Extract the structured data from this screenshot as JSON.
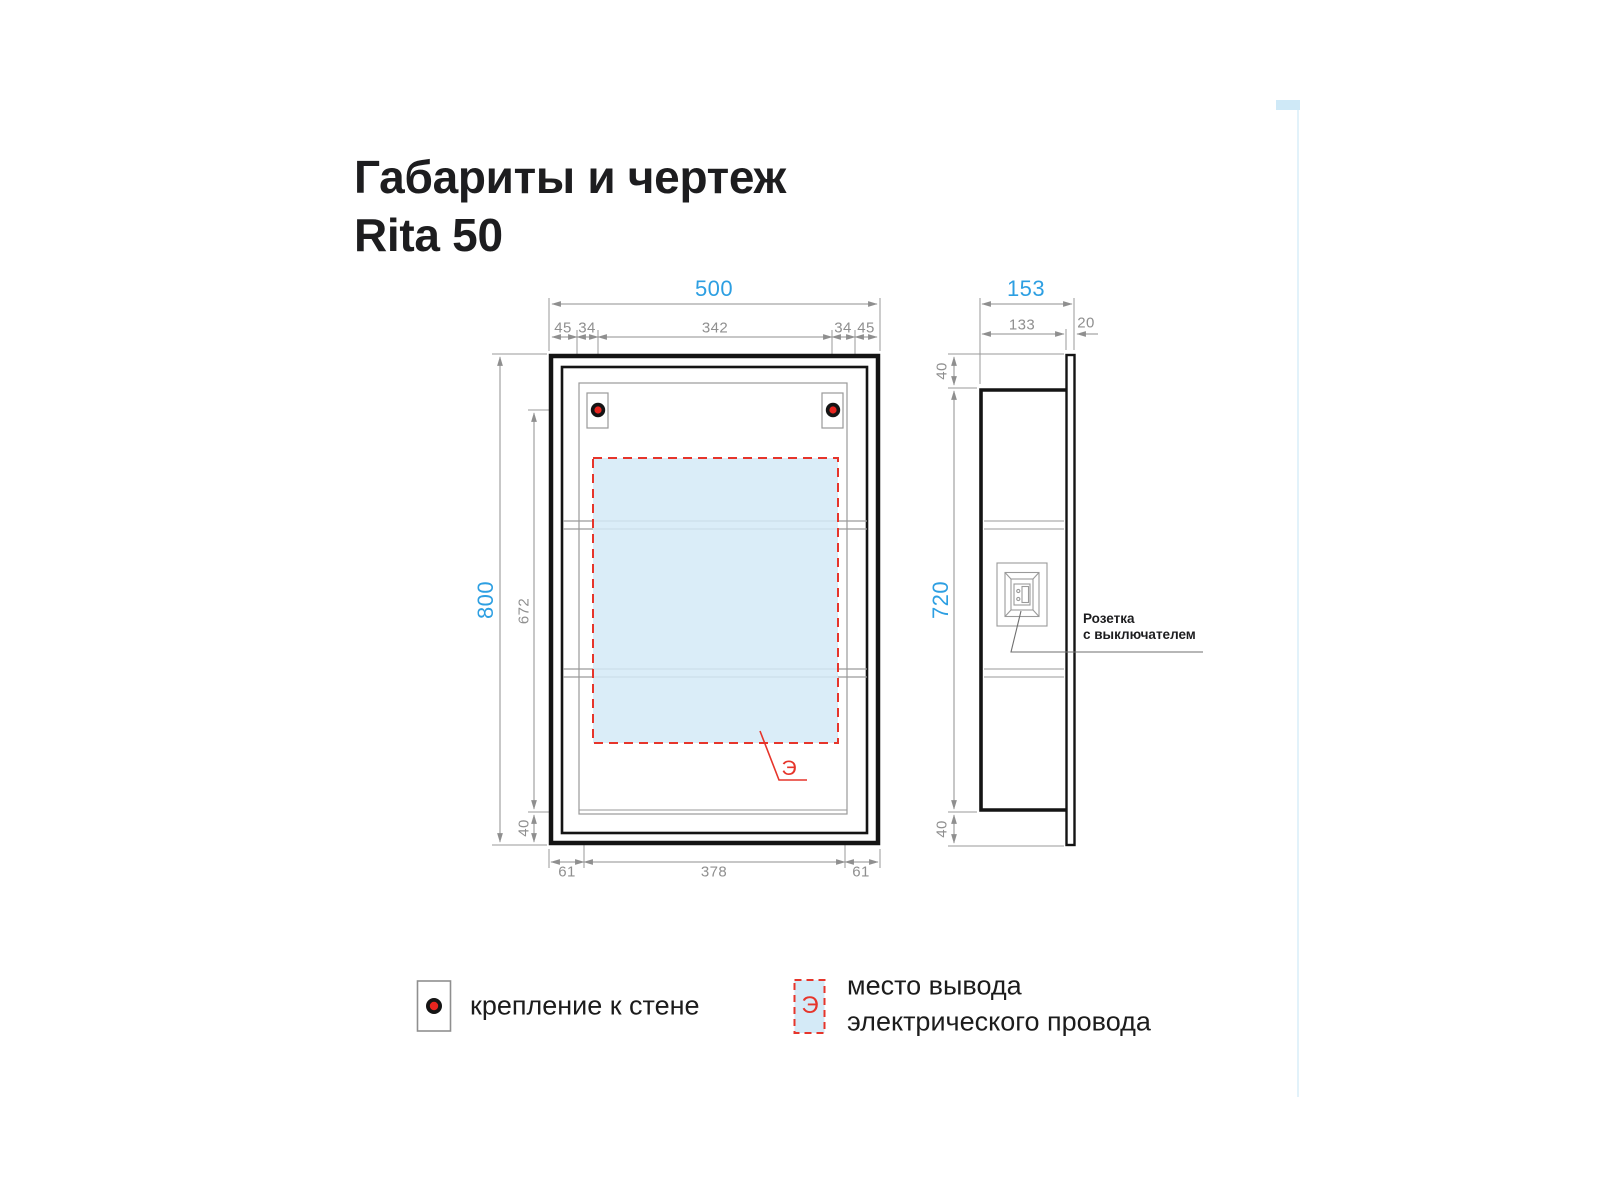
{
  "title": {
    "line1": "Габариты и чертеж",
    "line2": "Rita 50"
  },
  "front_view": {
    "dim_width_total": "500",
    "dim_top_segments": [
      "45",
      "34",
      "342",
      "34",
      "45"
    ],
    "dim_height_total": "800",
    "dim_inner_height": "672",
    "dim_bottom_offset": "40",
    "dim_bottom_segments": [
      "61",
      "378",
      "61"
    ],
    "electric_symbol": "Э"
  },
  "side_view": {
    "dim_width_total": "153",
    "dim_body_depth": "133",
    "dim_door_thickness": "20",
    "dim_top_margin": "40",
    "dim_body_height": "720",
    "dim_bottom_margin": "40",
    "socket_label_line1": "Розетка",
    "socket_label_line2": "с выключателем"
  },
  "legend": {
    "mount": {
      "label": "крепление к стене"
    },
    "electric": {
      "symbol": "Э",
      "label_line1": "место вывода",
      "label_line2": "электрического провода"
    }
  },
  "colors": {
    "accent_blue": "#2d9fe2",
    "dim_gray": "#8f8f8f",
    "line_black": "#141414",
    "red": "#e6352b",
    "panel_fill": "#d4eaf7"
  }
}
